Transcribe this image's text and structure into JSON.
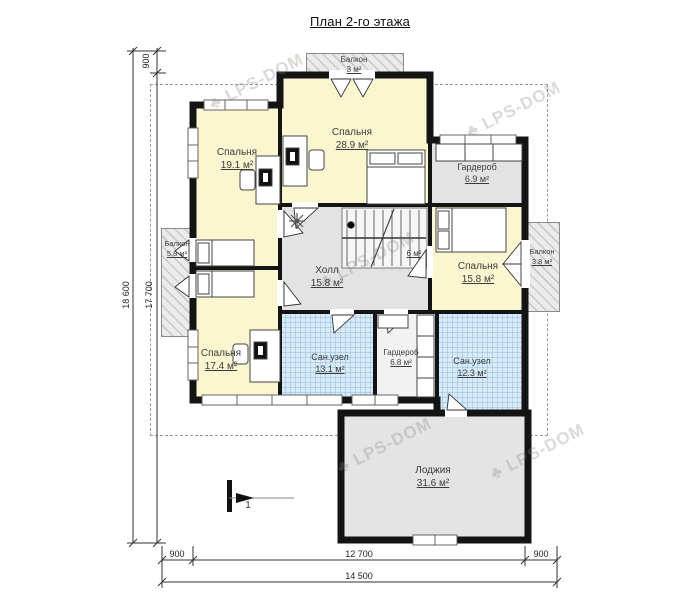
{
  "title": "План 2-го этажа",
  "watermark": {
    "text": "LPS-DOM"
  },
  "rooms": {
    "balcony_top": {
      "name": "Балкон",
      "area": "3 м²"
    },
    "bedroom_191": {
      "name": "Спальня",
      "area": "19.1 м²"
    },
    "bedroom_289": {
      "name": "Спальня",
      "area": "28.9 м²"
    },
    "wardrobe_69": {
      "name": "Гардероб",
      "area": "6.9 м²"
    },
    "balcony_left": {
      "name": "Балкон",
      "area": "5.8 м²"
    },
    "hall": {
      "name": "Холл",
      "area": "15.8 м²"
    },
    "stairs": {
      "area": "6 м²"
    },
    "bedroom_158": {
      "name": "Спальня",
      "area": "15.8 м²"
    },
    "balcony_right": {
      "name": "Балкон",
      "area": "3.8 м²"
    },
    "bedroom_174": {
      "name": "Спальня",
      "area": "17.4 м²"
    },
    "bath_131": {
      "name": "Сан.узел",
      "area": "13.1 м²"
    },
    "wardrobe_68": {
      "name": "Гардероб",
      "area": "6.8 м²"
    },
    "bath_123": {
      "name": "Сан.узел",
      "area": "12.3 м²"
    },
    "loggia": {
      "name": "Лоджия",
      "area": "31.6 м²"
    }
  },
  "dimensions": {
    "left_total": "18 600",
    "left_main": "17 700",
    "left_top": "900",
    "bottom_left": "900",
    "bottom_main": "12 700",
    "bottom_right": "900",
    "bottom_total": "14 500"
  },
  "section_marker": "1",
  "colors": {
    "bedroom": "#faf6d0",
    "hall": "#e3e3e3",
    "bath": "#d8ebf9",
    "wall": "#141414"
  }
}
